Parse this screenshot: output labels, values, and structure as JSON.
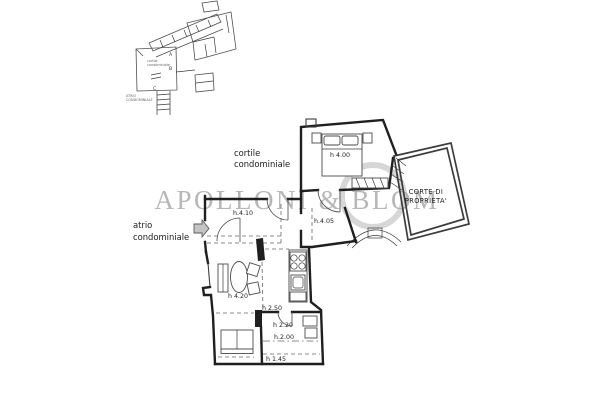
{
  "watermark": {
    "text": "APOLLONI & BLOM"
  },
  "site_plan": {
    "courtyard_line1": "cortile",
    "courtyard_line2": "condominiale",
    "atrium_line1": "ATRIO",
    "atrium_line2": "CONDOMINIALE",
    "marker_a": "A",
    "marker_b": "B",
    "marker_c": "C"
  },
  "main_plan": {
    "courtyard_label": {
      "line1": "cortile",
      "line2": "condominiale"
    },
    "atrium_label": {
      "line1": "atrio",
      "line2": "condominiale"
    },
    "corte_label": {
      "line1": "CORTE DI",
      "line2": "PROPRIETA'"
    },
    "heights": {
      "bedroom": "h 4.00",
      "hall": "h.4.10",
      "vestibule": "h.4.05",
      "living": "h 4.20",
      "lowered_1": "h 2.50",
      "lowered_2": "h 2.20",
      "lowered_3": "h.2.00",
      "lowered_4": "h 1.45"
    }
  },
  "colors": {
    "wall": "#1f1f1f",
    "thin_line": "#3c3c3c",
    "dashed": "#666666",
    "watermark": "#a6a6a6",
    "background": "#ffffff"
  }
}
